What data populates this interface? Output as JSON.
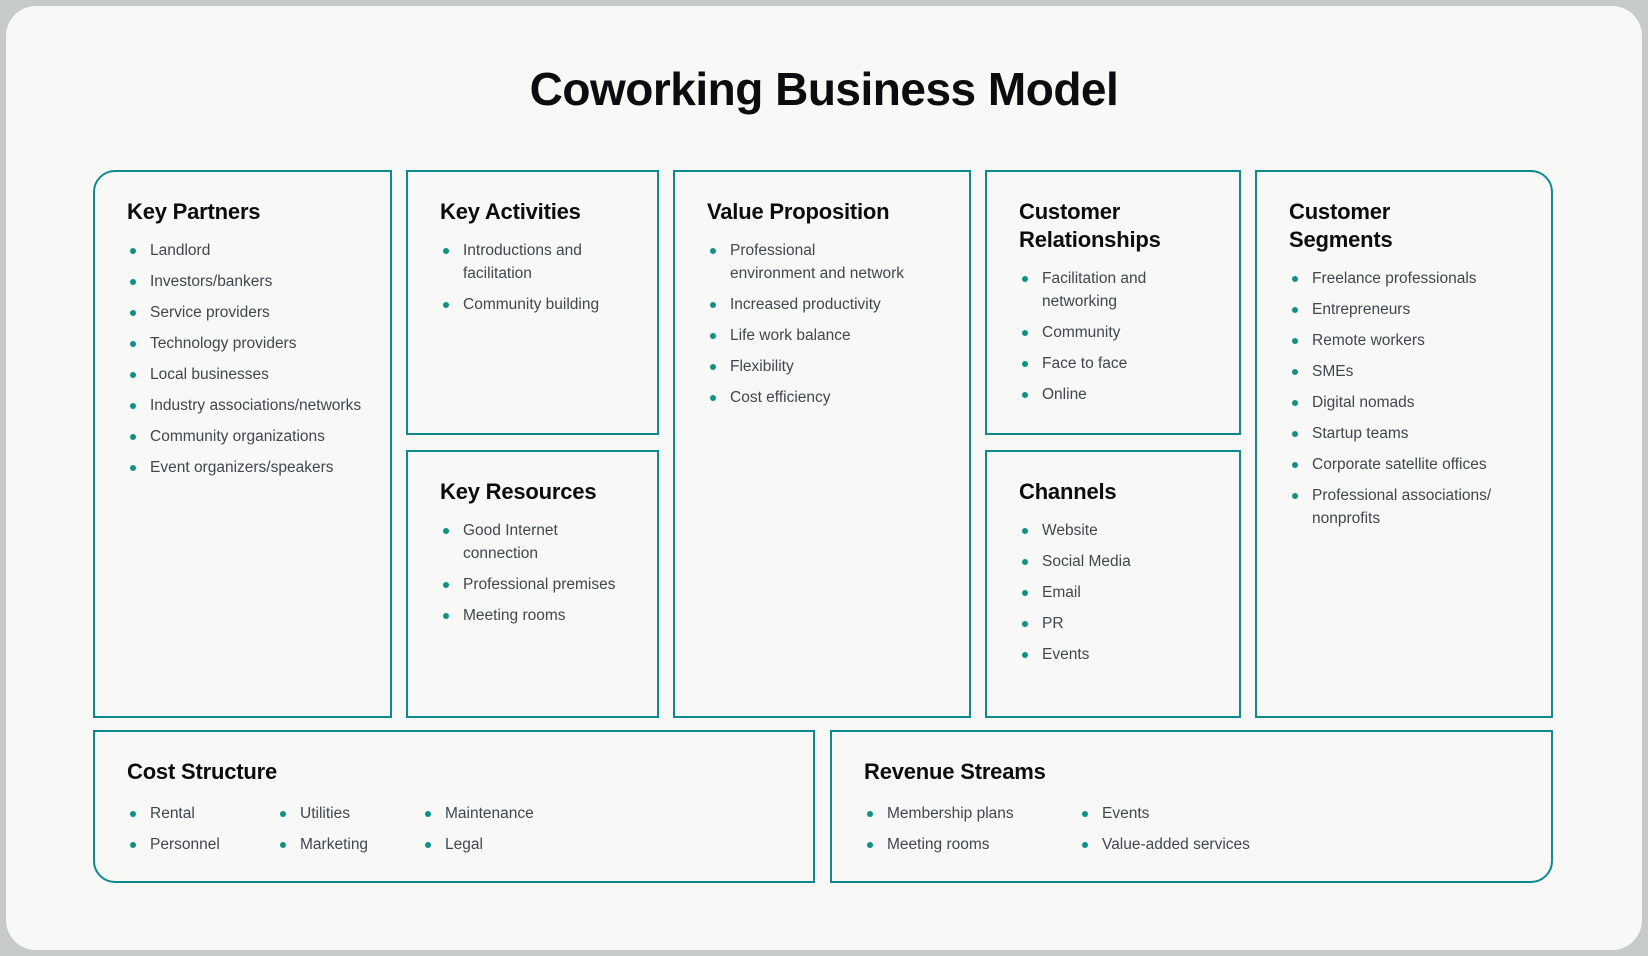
{
  "title": "Coworking Business Model",
  "colors": {
    "border_teal": "#0e8a8e",
    "bullet_teal": "#0f9285",
    "heading_text": "#0b0c0e",
    "body_text": "#3f474f",
    "card_background": "#f8f8f7",
    "page_background": "#c7cacb"
  },
  "boxes": {
    "key_partners": {
      "title": "Key Partners",
      "items": [
        "Landlord",
        "Investors/bankers",
        "Service providers",
        "Technology providers",
        "Local businesses",
        "Industry associations/​networks",
        "Community organizations",
        "Event organizers/speakers"
      ]
    },
    "key_activities": {
      "title": "Key Activities",
      "items": [
        "Introductions and facilitation",
        "Community building"
      ]
    },
    "key_resources": {
      "title": "Key Resources",
      "items": [
        "Good Internet connection",
        "Professional premises",
        "Meeting rooms"
      ]
    },
    "value_proposition": {
      "title": "Value Proposition",
      "items": [
        "Professional\nenvironment and network",
        "Increased productivity",
        "Life work balance",
        "Flexibility",
        "Cost efficiency"
      ]
    },
    "customer_relationships": {
      "title": "Customer\nRelationships",
      "items": [
        "Facilitation and networking",
        "Community",
        "Face to face",
        "Online"
      ]
    },
    "channels": {
      "title": "Channels",
      "items": [
        "Website",
        "Social Media",
        "Email",
        "PR",
        "Events"
      ]
    },
    "customer_segments": {
      "title": "Customer\nSegments",
      "items": [
        "Freelance professionals",
        "Entrepreneurs",
        "Remote workers",
        "SMEs",
        "Digital nomads",
        "Startup teams",
        "Corporate satellite offices",
        "Professional associations/​nonprofits"
      ]
    },
    "cost_structure": {
      "title": "Cost Structure",
      "columns": [
        [
          "Rental",
          "Personnel"
        ],
        [
          "Utilities",
          "Marketing"
        ],
        [
          "Maintenance",
          "Legal"
        ]
      ]
    },
    "revenue_streams": {
      "title": "Revenue Streams",
      "columns": [
        [
          "Membership plans",
          "Meeting rooms"
        ],
        [
          "Events",
          "Value-added services"
        ]
      ]
    }
  }
}
